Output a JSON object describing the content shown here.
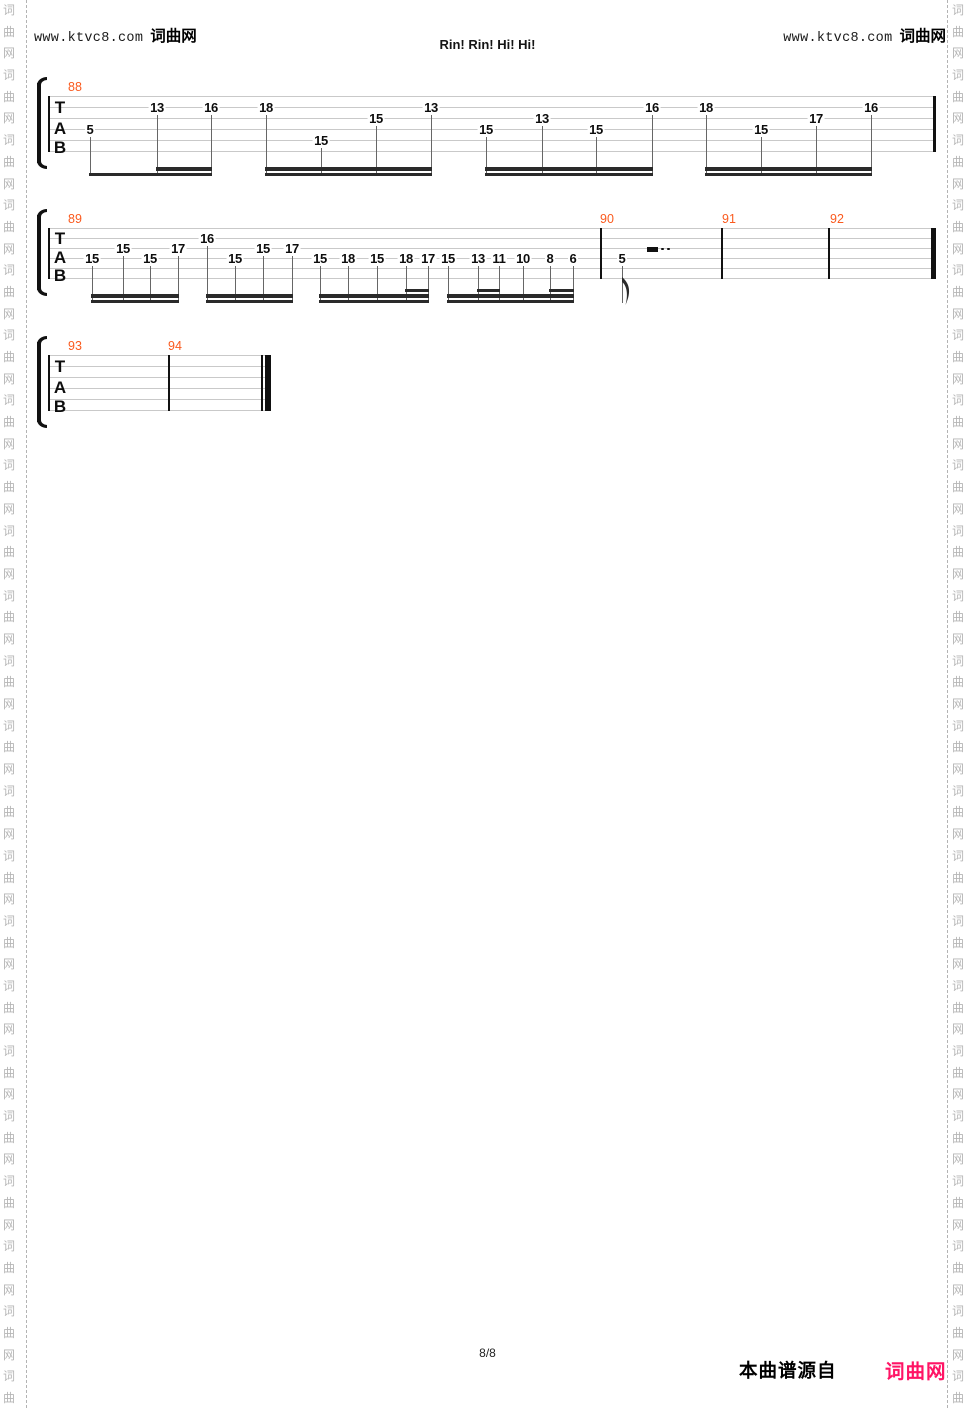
{
  "page": {
    "width": 975,
    "height": 1408
  },
  "colors": {
    "measure_number": "#fa5a1e",
    "staff_line": "#c9c9c9",
    "stem": "#666666",
    "beam": "#2a2a2a",
    "ink": "#111111",
    "watermark": "#b6b6b6",
    "brand_pink": "#ff1465"
  },
  "header": {
    "left": {
      "site": "www.ktvc8.com",
      "brand": "词曲网"
    },
    "right": {
      "site": "www.ktvc8.com",
      "brand": "词曲网"
    },
    "title": "Rin! Rin! Hi! Hi!"
  },
  "footer": {
    "page_indicator": "8/8",
    "source_text": "本曲谱源自",
    "brand": "词曲网"
  },
  "watermark": {
    "text": "词曲网",
    "char_count": 66,
    "row_height": 21.7,
    "left_col_x": 1,
    "right_col_x": 950,
    "left_line_x": 26,
    "right_line_x": 947
  },
  "staves": [
    {
      "clef": "TAB",
      "x1": 48,
      "x2": 936,
      "top": 96,
      "gap": 11,
      "bracket_x": 36,
      "stem_bottom": 176,
      "measure_labels": [
        {
          "text": "88",
          "x": 68
        }
      ],
      "barlines": [
        {
          "x": 48,
          "w": 1.5
        },
        {
          "x": 933,
          "w": 3
        }
      ],
      "notes": [
        {
          "fret": "5",
          "x": 90,
          "string": 4
        },
        {
          "fret": "13",
          "x": 157,
          "string": 2
        },
        {
          "fret": "16",
          "x": 211,
          "string": 2
        },
        {
          "fret": "18",
          "x": 266,
          "string": 2
        },
        {
          "fret": "15",
          "x": 321,
          "string": 5
        },
        {
          "fret": "15",
          "x": 376,
          "string": 3
        },
        {
          "fret": "13",
          "x": 431,
          "string": 2
        },
        {
          "fret": "15",
          "x": 486,
          "string": 4
        },
        {
          "fret": "13",
          "x": 542,
          "string": 3
        },
        {
          "fret": "15",
          "x": 596,
          "string": 4
        },
        {
          "fret": "16",
          "x": 652,
          "string": 2
        },
        {
          "fret": "18",
          "x": 706,
          "string": 2
        },
        {
          "fret": "15",
          "x": 761,
          "string": 4
        },
        {
          "fret": "17",
          "x": 816,
          "string": 3
        },
        {
          "fret": "16",
          "x": 871,
          "string": 2
        }
      ],
      "beams": [
        {
          "x1": 90,
          "x2": 211,
          "level": 0
        },
        {
          "x1": 157,
          "x2": 211,
          "level": 1
        },
        {
          "x1": 266,
          "x2": 431,
          "level": 0
        },
        {
          "x1": 266,
          "x2": 431,
          "level": 1
        },
        {
          "x1": 486,
          "x2": 652,
          "level": 0
        },
        {
          "x1": 486,
          "x2": 652,
          "level": 1
        },
        {
          "x1": 706,
          "x2": 871,
          "level": 0
        },
        {
          "x1": 706,
          "x2": 871,
          "level": 1
        }
      ],
      "rests": [],
      "flags": []
    },
    {
      "clef": "TAB",
      "x1": 48,
      "x2": 936,
      "top": 228,
      "gap": 10,
      "bracket_x": 36,
      "stem_bottom": 303,
      "measure_labels": [
        {
          "text": "89",
          "x": 68
        },
        {
          "text": "90",
          "x": 600
        },
        {
          "text": "91",
          "x": 722
        },
        {
          "text": "92",
          "x": 830
        }
      ],
      "barlines": [
        {
          "x": 48,
          "w": 1.5
        },
        {
          "x": 600,
          "w": 1.5
        },
        {
          "x": 721,
          "w": 1.5
        },
        {
          "x": 828,
          "w": 1.5
        },
        {
          "x": 931,
          "w": 4.5
        }
      ],
      "notes": [
        {
          "fret": "15",
          "x": 92,
          "string": 4
        },
        {
          "fret": "15",
          "x": 123,
          "string": 3
        },
        {
          "fret": "15",
          "x": 150,
          "string": 4
        },
        {
          "fret": "17",
          "x": 178,
          "string": 3
        },
        {
          "fret": "16",
          "x": 207,
          "string": 2
        },
        {
          "fret": "15",
          "x": 235,
          "string": 4
        },
        {
          "fret": "15",
          "x": 263,
          "string": 3
        },
        {
          "fret": "17",
          "x": 292,
          "string": 3
        },
        {
          "fret": "15",
          "x": 320,
          "string": 4
        },
        {
          "fret": "18",
          "x": 348,
          "string": 4
        },
        {
          "fret": "15",
          "x": 377,
          "string": 4
        },
        {
          "fret": "18",
          "x": 406,
          "string": 4
        },
        {
          "fret": "17",
          "x": 428,
          "string": 4
        },
        {
          "fret": "15",
          "x": 448,
          "string": 4
        },
        {
          "fret": "13",
          "x": 478,
          "string": 4
        },
        {
          "fret": "11",
          "x": 499,
          "string": 4
        },
        {
          "fret": "10",
          "x": 523,
          "string": 4
        },
        {
          "fret": "8",
          "x": 550,
          "string": 4
        },
        {
          "fret": "6",
          "x": 573,
          "string": 4
        },
        {
          "fret": "5",
          "x": 622,
          "string": 4,
          "flag": true
        }
      ],
      "beams": [
        {
          "x1": 92,
          "x2": 178,
          "level": 0
        },
        {
          "x1": 92,
          "x2": 178,
          "level": 1
        },
        {
          "x1": 207,
          "x2": 292,
          "level": 0
        },
        {
          "x1": 207,
          "x2": 292,
          "level": 1
        },
        {
          "x1": 320,
          "x2": 428,
          "level": 0
        },
        {
          "x1": 320,
          "x2": 428,
          "level": 1
        },
        {
          "x1": 406,
          "x2": 428,
          "level": 2
        },
        {
          "x1": 448,
          "x2": 573,
          "level": 0
        },
        {
          "x1": 448,
          "x2": 573,
          "level": 1
        },
        {
          "x1": 478,
          "x2": 499,
          "level": 2
        },
        {
          "x1": 550,
          "x2": 573,
          "level": 2
        }
      ],
      "rests": [
        {
          "x": 647,
          "w": 11,
          "dots": [
            661,
            667
          ]
        }
      ],
      "flags": [
        {
          "x": 622
        }
      ]
    },
    {
      "clef": "TAB",
      "x1": 48,
      "x2": 270,
      "top": 355,
      "gap": 11,
      "bracket_x": 36,
      "stem_bottom": null,
      "measure_labels": [
        {
          "text": "93",
          "x": 68
        },
        {
          "text": "94",
          "x": 168
        }
      ],
      "barlines": [
        {
          "x": 48,
          "w": 1.5
        },
        {
          "x": 168,
          "w": 1.5
        },
        {
          "x": 261,
          "w": 1.5
        },
        {
          "x": 265,
          "w": 5.5
        }
      ],
      "notes": [],
      "beams": [],
      "rests": [],
      "flags": []
    }
  ]
}
